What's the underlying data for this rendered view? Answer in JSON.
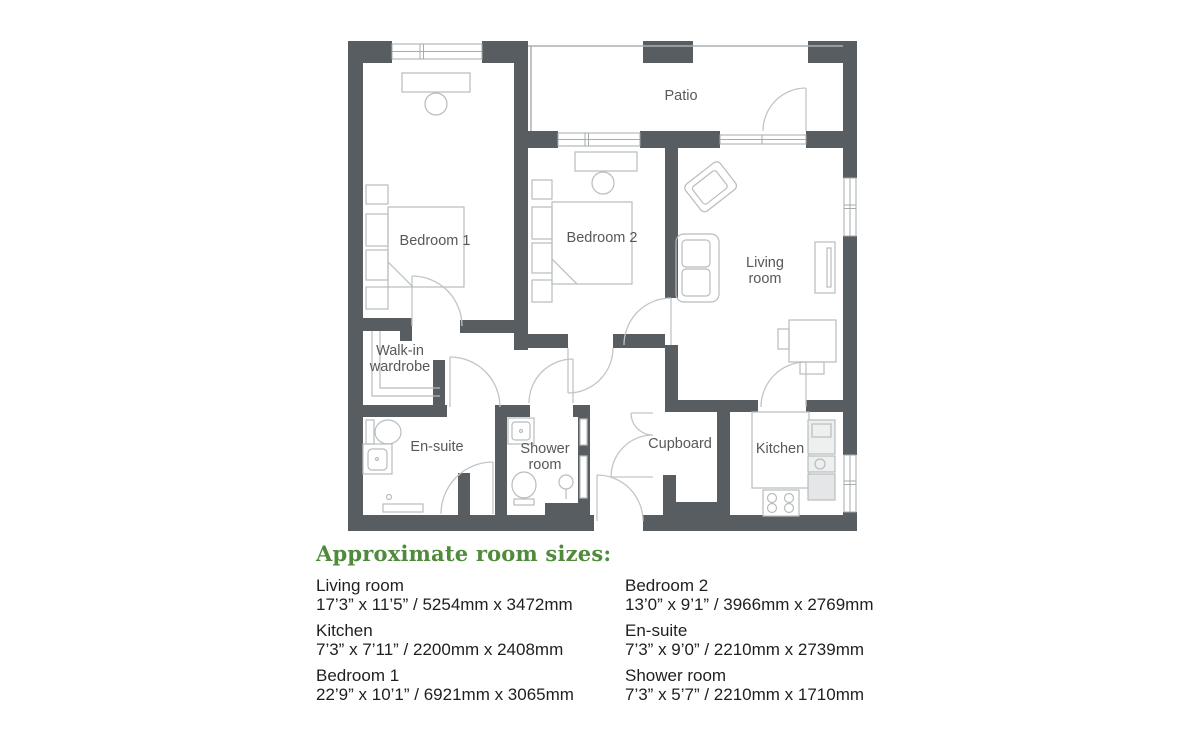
{
  "floorplan": {
    "rooms": {
      "patio": {
        "label": "Patio"
      },
      "bedroom1": {
        "label": "Bedroom 1"
      },
      "bedroom2": {
        "label": "Bedroom 2"
      },
      "living_room": {
        "line1": "Living",
        "line2": "room"
      },
      "walk_in_wardrobe": {
        "line1": "Walk-in",
        "line2": "wardrobe"
      },
      "en_suite": {
        "label": "En-suite"
      },
      "shower_room": {
        "line1": "Shower",
        "line2": "room"
      },
      "cupboard": {
        "label": "Cupboard"
      },
      "kitchen": {
        "label": "Kitchen"
      }
    },
    "colors": {
      "wall": "#575d60",
      "furniture_line": "#b8bcbe",
      "door_line": "#c2c5c7",
      "room_label_text": "#57585a"
    }
  },
  "room_sizes": {
    "heading": "Approximate room sizes:",
    "heading_color": "#4f8b3a",
    "columns": [
      {
        "items": [
          {
            "name": "Living room",
            "dimensions": "17’3” x 11’5” / 5254mm x 3472mm"
          },
          {
            "name": "Kitchen",
            "dimensions": "7’3” x 7’11” / 2200mm x 2408mm"
          },
          {
            "name": "Bedroom 1",
            "dimensions": "22’9” x 10’1” / 6921mm x 3065mm"
          }
        ]
      },
      {
        "items": [
          {
            "name": "Bedroom 2",
            "dimensions": "13’0” x 9’1” / 3966mm x 2769mm"
          },
          {
            "name": "En-suite",
            "dimensions": "7’3” x 9’0” / 2210mm x 2739mm"
          },
          {
            "name": "Shower room",
            "dimensions": "7’3” x 5’7” / 2210mm x 1710mm"
          }
        ]
      }
    ]
  }
}
